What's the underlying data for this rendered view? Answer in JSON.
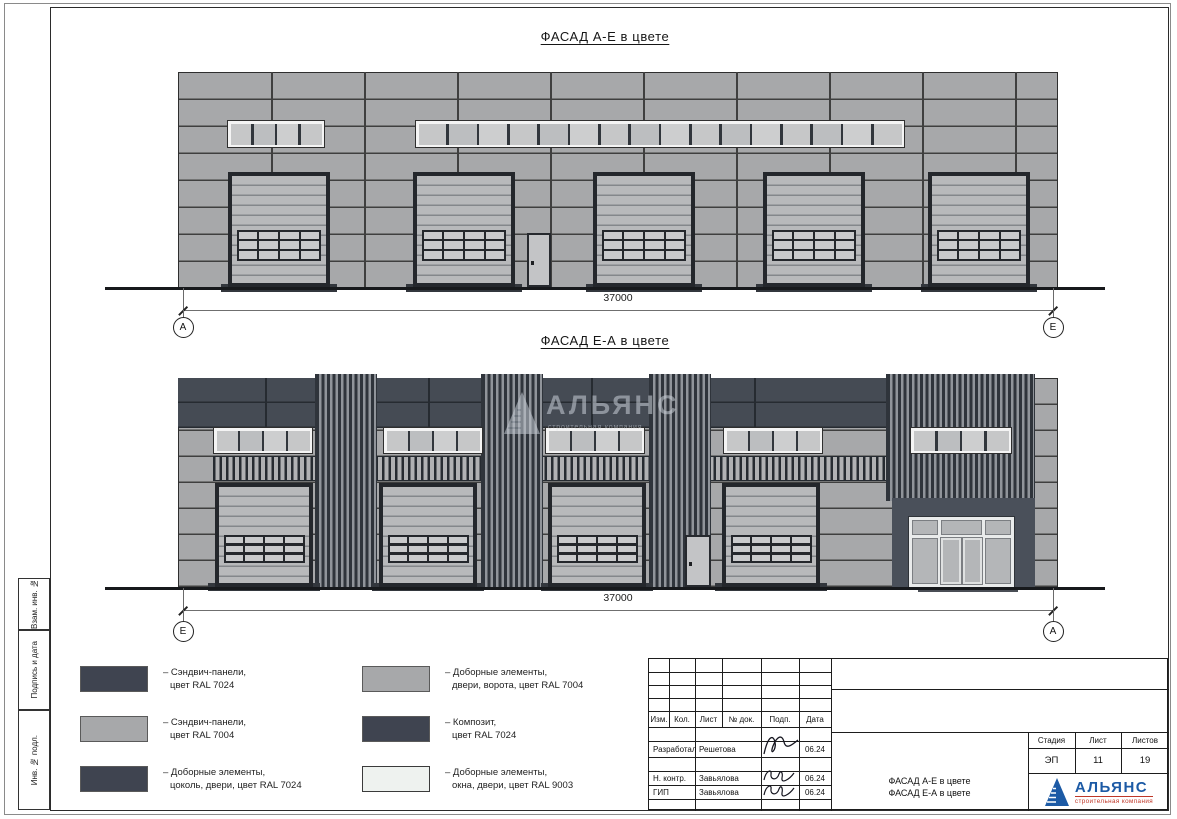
{
  "sheet": {
    "side_labels": [
      "Взам. инв. №",
      "Подпись и дата",
      "Инв. № подл."
    ]
  },
  "facade1": {
    "title": "ФАСАД А-Е в цвете",
    "dimension": "37000",
    "axis_left": "А",
    "axis_right": "Е"
  },
  "facade2": {
    "title": "ФАСАД Е-А в цвете",
    "dimension": "37000",
    "axis_left": "Е",
    "axis_right": "А"
  },
  "watermark": {
    "title": "АЛЬЯНС",
    "subtitle": "строительная компания"
  },
  "legend": {
    "items": [
      {
        "color": "#3f4450",
        "lines": [
          "– Сэндвич-панели,",
          "цвет RAL 7024"
        ]
      },
      {
        "color": "#a7a8aa",
        "lines": [
          "– Сэндвич-панели,",
          "цвет RAL 7004"
        ]
      },
      {
        "color": "#3f4450",
        "lines": [
          "– Доборные элементы,",
          "цоколь, двери, цвет RAL 7024"
        ]
      },
      {
        "color": "#a7a8aa",
        "lines": [
          "– Доборные элементы,",
          "двери, ворота, цвет RAL 7004"
        ]
      },
      {
        "color": "#3f4450",
        "lines": [
          "– Композит,",
          "цвет RAL 7024"
        ]
      },
      {
        "color": "#eef2ef",
        "lines": [
          "– Доборные элементы,",
          "окна, двери, цвет RAL 9003"
        ]
      }
    ]
  },
  "titleblock": {
    "header_cols": [
      "Изм.",
      "Кол.",
      "Лист",
      "№ док.",
      "Подп.",
      "Дата"
    ],
    "rows": [
      {
        "role": "Разработал",
        "name": "Решетова",
        "date": "06.24"
      },
      {
        "role": "Н. контр.",
        "name": "Завьялова",
        "date": "06.24"
      },
      {
        "role": "ГИП",
        "name": "Завьялова",
        "date": "06.24"
      }
    ],
    "doc_title_line1": "ФАСАД А-Е в цвете",
    "doc_title_line2": "ФАСАД Е-А в цвете",
    "stage_label": "Стадия",
    "sheet_label": "Лист",
    "sheets_label": "Листов",
    "stage": "ЭП",
    "sheet": "11",
    "sheets": "19"
  },
  "logo": {
    "name": "АЛЬЯНС",
    "subtitle": "строительная компания"
  },
  "palette": {
    "ral7024": "#454b54",
    "ral7004": "#a7a8aa",
    "ral9003": "#eef2ef",
    "wall_line": "#3f3f3f",
    "dark_line": "#262b31",
    "door_frame": "#24272c",
    "door_slat": "#b8b9bb",
    "door_slat_line": "#84878b",
    "pane": "#c6c7c8",
    "louver_dark": "#2f343b",
    "louver_light": "#90949a",
    "ground": "#17191c",
    "accent_blue": "#1c5aa5",
    "accent_red": "#bf3728"
  }
}
